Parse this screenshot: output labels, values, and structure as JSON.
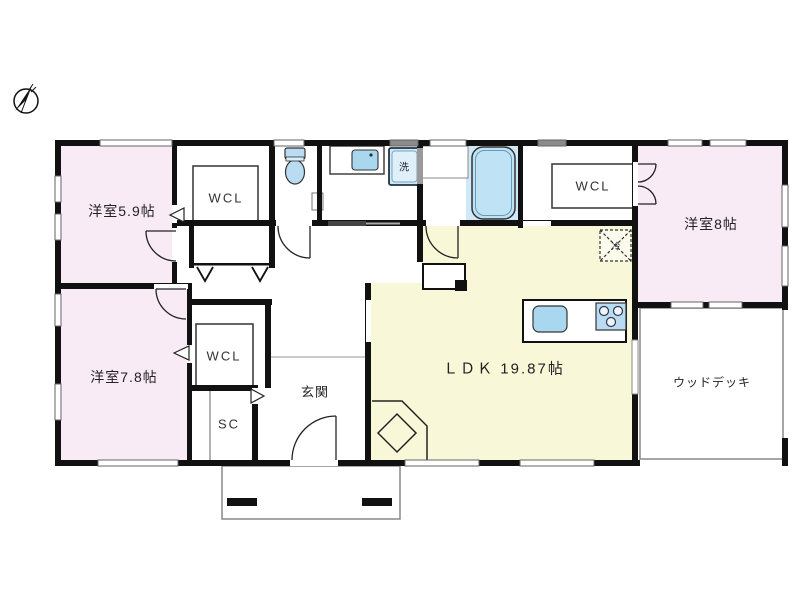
{
  "plan": {
    "type": "single-story floor plan",
    "rooms": {
      "room_59": {
        "label": "洋室5.9帖"
      },
      "room_78": {
        "label": "洋室7.8帖"
      },
      "room_8": {
        "label": "洋室8帖"
      },
      "ldk": {
        "label": "ＬＤＫ 19.87帖"
      },
      "genkan": {
        "label": "玄関"
      },
      "wood_deck": {
        "label": "ウッドデッキ"
      },
      "wcl_top_left": {
        "label": "WCL"
      },
      "wcl_top_right": {
        "label": "WCL"
      },
      "wcl_middle": {
        "label": "WCL"
      },
      "shoe_closet": {
        "label": "SC"
      }
    },
    "fixtures": {
      "washing_machine": {
        "label": "洗"
      },
      "refrigerator": {
        "label": "冷"
      }
    },
    "colors": {
      "room_pink": "#f8ebf6",
      "ldk_yellow": "#f8f8d8",
      "bath_blue": "#cfe9f7",
      "fixture_blue": "#b9dcf2",
      "wall_black": "#111111",
      "thin_gray": "#888888"
    }
  }
}
